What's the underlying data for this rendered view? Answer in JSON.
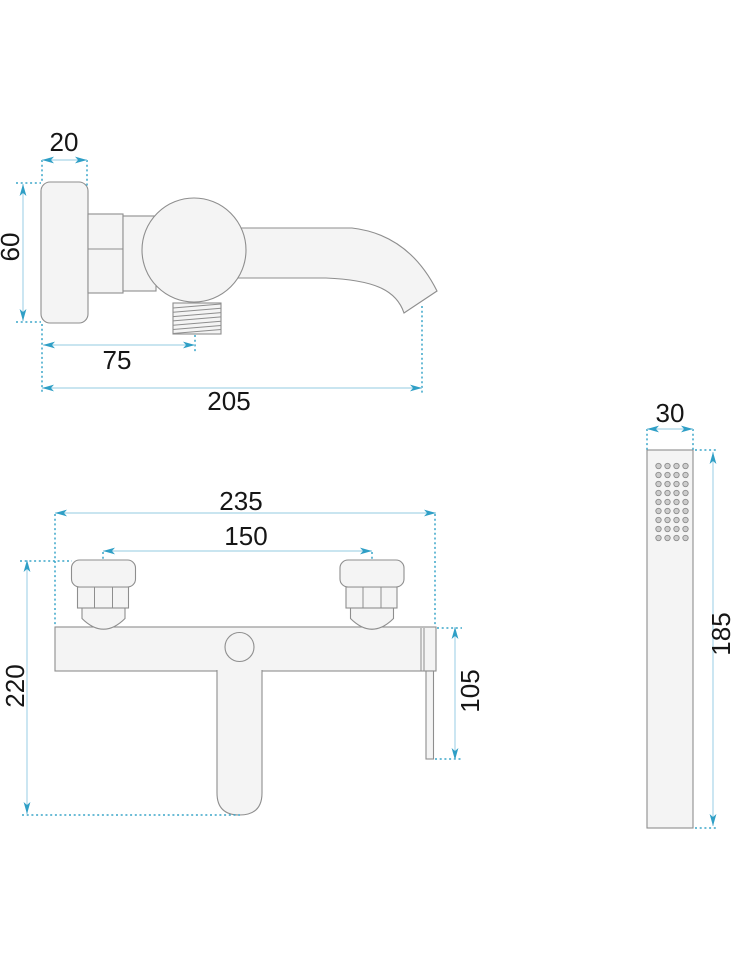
{
  "drawing": {
    "type": "technical-dimension-drawing",
    "subject": "wall-mounted bath mixer tap with hand shower",
    "views": {
      "side_view": "faucet side profile with spout",
      "front_view": "faucet front elevation",
      "hand_shower": "hand shower stick head"
    }
  },
  "colors": {
    "dimension_line": "#a9d5e8",
    "extension_line": "#3aa5c9",
    "arrow": "#2f9fc6",
    "part_outline": "#8e8e8e",
    "part_fill": "#f4f4f4",
    "label_text": "#161616",
    "background": "#ffffff"
  },
  "dimensions": {
    "side_view": {
      "plate_width_mm": "20",
      "plate_height_mm": "60",
      "outlet_offset_mm": "75",
      "spout_reach_mm": "205"
    },
    "front_view": {
      "body_width_mm": "235",
      "connection_spacing_mm": "150",
      "total_height_mm": "220",
      "lever_drop_mm": "105"
    },
    "hand_shower": {
      "head_width_mm": "30",
      "head_length_mm": "185"
    }
  }
}
